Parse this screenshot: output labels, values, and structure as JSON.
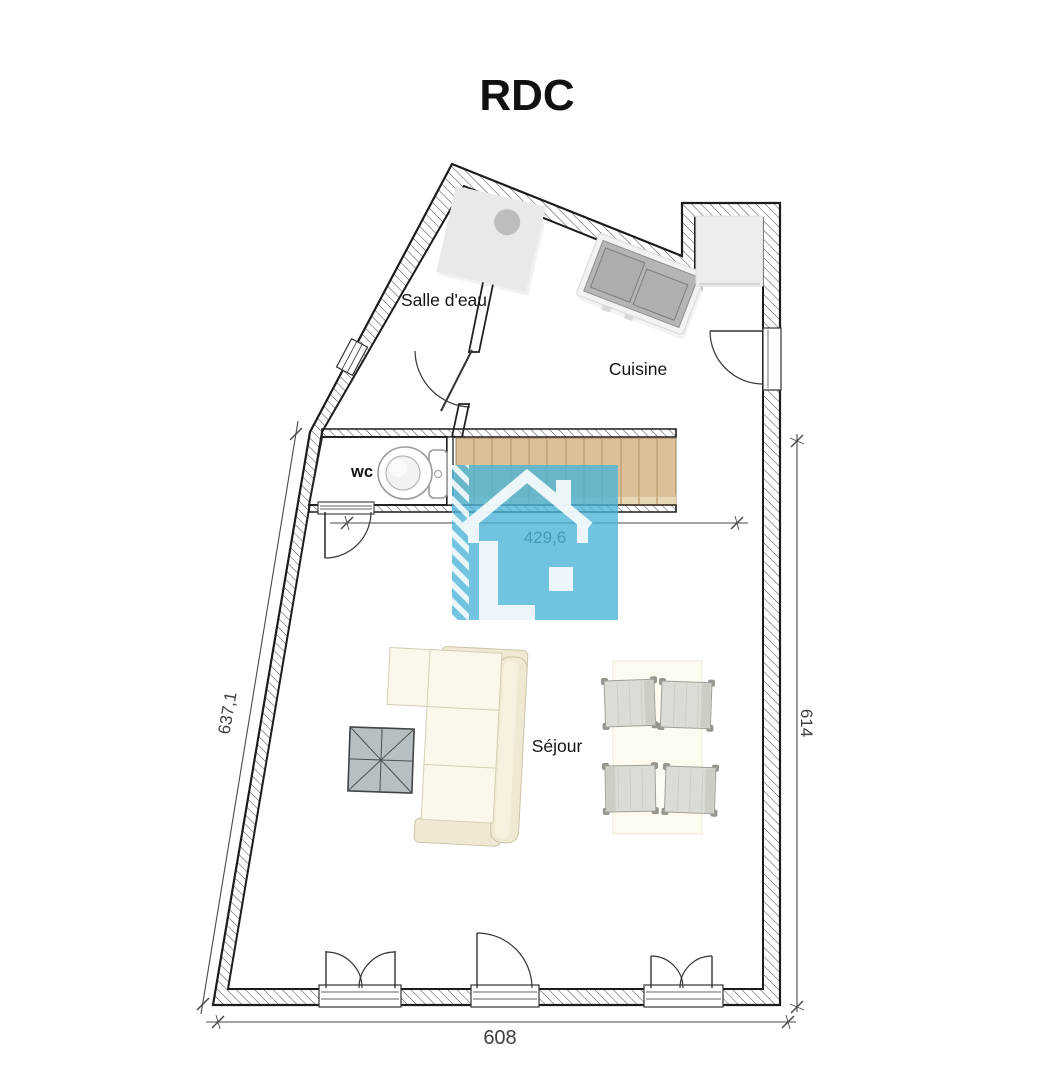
{
  "title": "RDC",
  "floor_plan": {
    "rooms": [
      {
        "id": "bathroom",
        "label": "Salle d'eau"
      },
      {
        "id": "kitchen",
        "label": "Cuisine"
      },
      {
        "id": "wc",
        "label": "wc"
      },
      {
        "id": "living_room",
        "label": "Séjour"
      }
    ],
    "dimensions": [
      {
        "id": "stair_span",
        "value": "429,6"
      },
      {
        "id": "left_wall",
        "value": "637,1"
      },
      {
        "id": "right_wall",
        "value": "614"
      },
      {
        "id": "bottom_wall",
        "value": "608"
      }
    ],
    "furniture": [
      "shower-tray",
      "kitchen-sink",
      "fridge",
      "toilet",
      "staircase",
      "corner-sofa",
      "coffee-table",
      "dining-table",
      "four-chairs"
    ],
    "doors": [
      "bathroom-door",
      "wc-door",
      "kitchen-entry-door",
      "double-patio-door-left",
      "single-door-center",
      "double-patio-door-right"
    ],
    "colors": {
      "wall_line": "#1c1c1c",
      "stair_wood": "#ddc098",
      "stair_tread_line": "#b99a6d",
      "watermark_blue": "#48b4d7",
      "sofa_cream": "#fbf7ea",
      "coffee_table_gray": "#b6bfc1",
      "chair_gray": "#dcdcd6",
      "dimension_text": "#3f3f3f"
    },
    "watermark": "house-logo"
  }
}
